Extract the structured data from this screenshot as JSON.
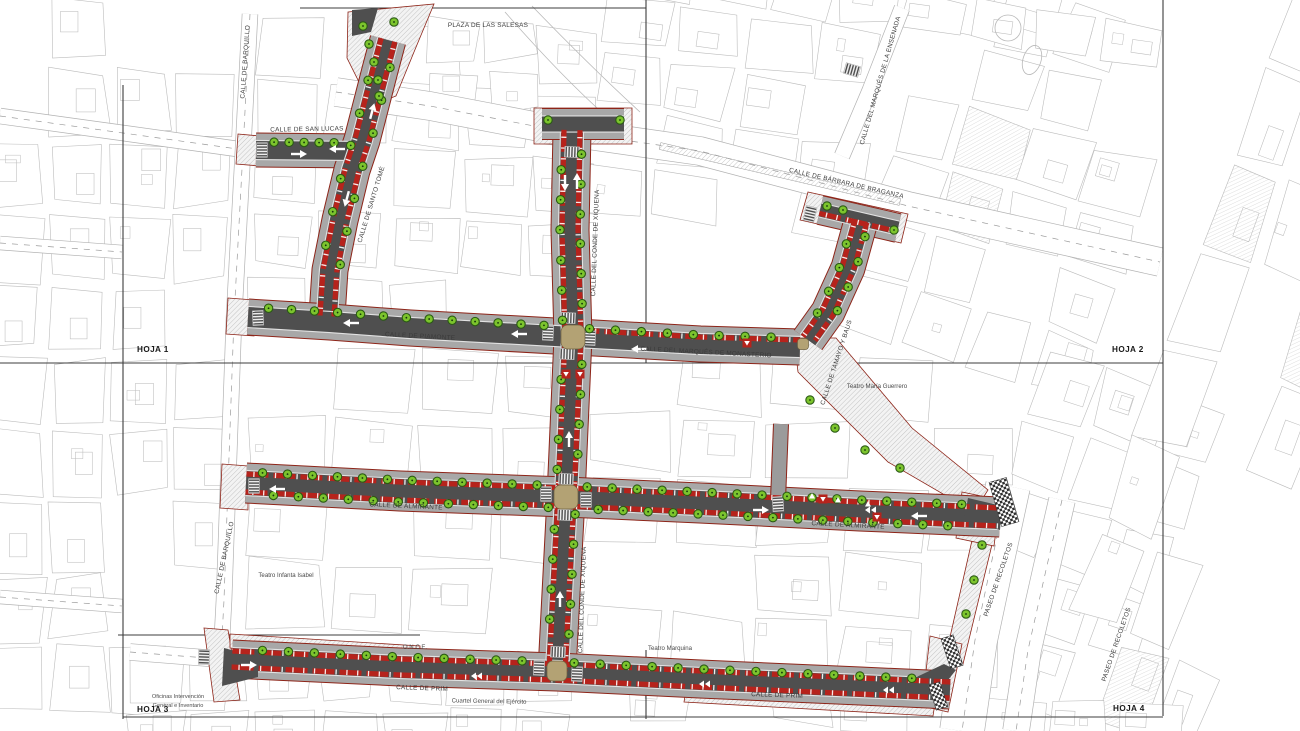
{
  "labels": {
    "plaza_salesas": "PLAZA DE LAS SALESAS",
    "calle_barquillo": "CALLE DE BARQUILLO",
    "calle_san_lucas": "CALLE DE SAN LUCAS",
    "calle_santo_tome": "CALLE DE SANTO TOMÉ",
    "calle_conde_xiquena": "CALLE DEL CONDE DE XIQUENA",
    "calle_barbara_braganza": "CALLE DE BÁRBARA DE BRAGANZA",
    "calle_marques_ensenada": "CALLE DEL MARQUÉS DE LA ENSENADA",
    "calle_piamonte": "CALLE DE PIAMONTE",
    "calle_marques_monasterio": "CALLE DEL MARQUÉS DE MONASTERIO",
    "calle_tamayo_baus": "CALLE DE TAMAYO Y BAUS",
    "teatro_maria_guerrero": "Teatro María Guerrero",
    "calle_almirante": "CALLE DE ALMIRANTE",
    "teatro_infanta_isabel": "Teatro Infanta Isabel",
    "paseo_recoletos": "PASEO DE RECOLETOS",
    "once": "O.N.C.E.",
    "teatro_marquina": "Teatro Marquina",
    "calle_prim": "CALLE DE PRIM",
    "cuartel_general": "Cuartel General del Ejército",
    "oficinas_line1": "Oficinas Intervención",
    "oficinas_line2": "General e Inventario"
  },
  "sheets": {
    "hoja1": "HOJA 1",
    "hoja2": "HOJA 2",
    "hoja3": "HOJA 3",
    "hoja4": "HOJA 4"
  },
  "colors": {
    "parking_red": "#b6231c",
    "tree_green": "#7cc42d",
    "tree_ring": "#2a5a14",
    "roadway_gray": "#4f4f4f",
    "sidewalk_gray": "#a8a8a8",
    "curb_light": "#e2e2e2",
    "plan_outline_red": "#8d2418",
    "intersection_tan": "#b3a274",
    "frame_line": "#3c3c3c",
    "background_line": "#bcbcbc",
    "walkway_gray": "#9b9b9b"
  }
}
